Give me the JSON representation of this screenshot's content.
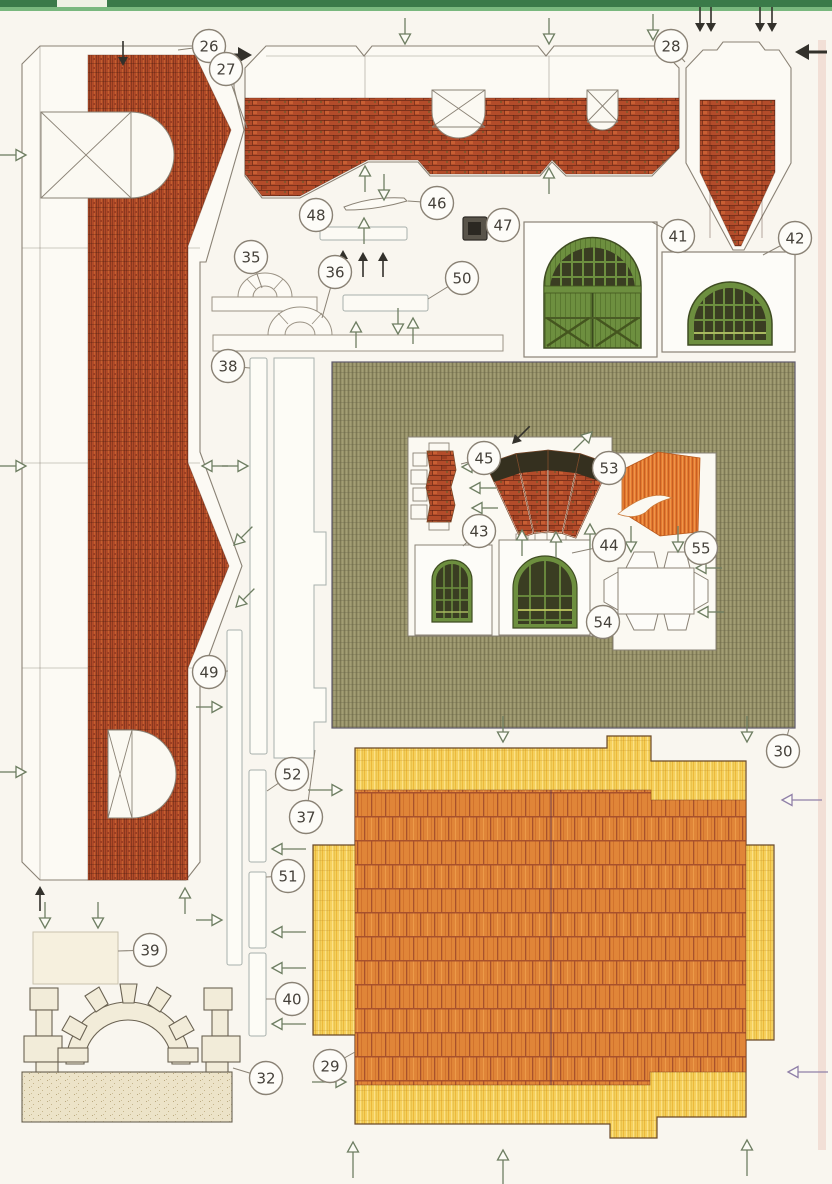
{
  "sheet": {
    "part_numbers": [
      "26",
      "27",
      "28",
      "29",
      "30",
      "32",
      "35",
      "36",
      "37",
      "38",
      "39",
      "40",
      "41",
      "42",
      "43",
      "44",
      "45",
      "46",
      "47",
      "48",
      "49",
      "50",
      "51",
      "52",
      "53",
      "54",
      "55"
    ]
  },
  "palette": {
    "page": "#f9f6ef",
    "brick": "#b04a28",
    "brick_dark": "#8f3a1f",
    "brick_light": "#c85f33",
    "olive": "#97926a",
    "olive_dark": "#7f7a55",
    "thatch": "#f5d05c",
    "thatch_dark": "#ecb93b",
    "tile_orange": "#e08538",
    "tile_line": "#a8512c",
    "door_green": "#6d8f3f",
    "pane_dark": "#3a3d22",
    "sand": "#ece3c8",
    "outline": "#8a8275",
    "arrow_open": "#6e7e62",
    "arrow_solid": "#33312b",
    "arrow_purple": "#9080a8",
    "top_bar_green": "#3a7a49",
    "top_bar_green_light": "#79b87e"
  },
  "callouts": [
    {
      "n": "26",
      "cx": 209,
      "cy": 46,
      "tx": 178,
      "ty": 50
    },
    {
      "n": "27",
      "cx": 226,
      "cy": 69,
      "tx": 247,
      "ty": 128
    },
    {
      "n": "28",
      "cx": 671,
      "cy": 46,
      "tx": 685,
      "ty": 62
    },
    {
      "n": "35",
      "cx": 251,
      "cy": 257,
      "tx": 262,
      "ty": 288
    },
    {
      "n": "36",
      "cx": 335,
      "cy": 272,
      "tx": 322,
      "ty": 318
    },
    {
      "n": "48",
      "cx": 316,
      "cy": 215,
      "tx": 324,
      "ty": 229
    },
    {
      "n": "46",
      "cx": 437,
      "cy": 203,
      "tx": 408,
      "ty": 201
    },
    {
      "n": "47",
      "cx": 503,
      "cy": 225,
      "tx": 488,
      "ty": 228
    },
    {
      "n": "50",
      "cx": 462,
      "cy": 278,
      "tx": 428,
      "ty": 299
    },
    {
      "n": "41",
      "cx": 678,
      "cy": 236,
      "tx": 652,
      "ty": 222
    },
    {
      "n": "42",
      "cx": 795,
      "cy": 238,
      "tx": 763,
      "ty": 255
    },
    {
      "n": "38",
      "cx": 228,
      "cy": 366,
      "tx": 250,
      "ty": 368
    },
    {
      "n": "30",
      "cx": 783,
      "cy": 751,
      "tx": 789,
      "ty": 729
    },
    {
      "n": "45",
      "cx": 484,
      "cy": 458,
      "tx": 461,
      "ty": 464
    },
    {
      "n": "53",
      "cx": 609,
      "cy": 468,
      "tx": 593,
      "ty": 472
    },
    {
      "n": "43",
      "cx": 479,
      "cy": 531,
      "tx": 463,
      "ty": 546
    },
    {
      "n": "44",
      "cx": 609,
      "cy": 545,
      "tx": 572,
      "ty": 553
    },
    {
      "n": "55",
      "cx": 701,
      "cy": 548,
      "tx": 695,
      "ty": 533
    },
    {
      "n": "54",
      "cx": 603,
      "cy": 622,
      "tx": 614,
      "ty": 610
    },
    {
      "n": "49",
      "cx": 209,
      "cy": 672,
      "tx": 228,
      "ty": 671
    },
    {
      "n": "52",
      "cx": 292,
      "cy": 774,
      "tx": 267,
      "ty": 791
    },
    {
      "n": "37",
      "cx": 306,
      "cy": 817,
      "tx": 315,
      "ty": 750
    },
    {
      "n": "51",
      "cx": 288,
      "cy": 876,
      "tx": 266,
      "ty": 877
    },
    {
      "n": "39",
      "cx": 150,
      "cy": 950,
      "tx": 118,
      "ty": 951
    },
    {
      "n": "40",
      "cx": 292,
      "cy": 999,
      "tx": 266,
      "ty": 999
    },
    {
      "n": "29",
      "cx": 330,
      "cy": 1066,
      "tx": 355,
      "ty": 1052
    },
    {
      "n": "32",
      "cx": 266,
      "cy": 1078,
      "tx": 233,
      "ty": 1068
    }
  ],
  "arrows": [
    {
      "x": 123,
      "y": 66,
      "d": "down",
      "s": "solid"
    },
    {
      "x": 26,
      "y": 155,
      "d": "right",
      "s": "open"
    },
    {
      "x": 252,
      "y": 55,
      "d": "right",
      "s": "solid",
      "big": true
    },
    {
      "x": 26,
      "y": 466,
      "d": "right",
      "s": "open"
    },
    {
      "x": 26,
      "y": 772,
      "d": "right",
      "s": "open"
    },
    {
      "x": 202,
      "y": 466,
      "d": "left",
      "s": "open"
    },
    {
      "x": 248,
      "y": 466,
      "d": "right",
      "s": "open"
    },
    {
      "x": 234,
      "y": 545,
      "d": "downleft",
      "s": "open"
    },
    {
      "x": 236,
      "y": 607,
      "d": "downleft",
      "s": "open"
    },
    {
      "x": 40,
      "y": 886,
      "d": "up",
      "s": "solid"
    },
    {
      "x": 185,
      "y": 888,
      "d": "up",
      "s": "open"
    },
    {
      "x": 45,
      "y": 928,
      "d": "down",
      "s": "open"
    },
    {
      "x": 98,
      "y": 928,
      "d": "down",
      "s": "open"
    },
    {
      "x": 222,
      "y": 920,
      "d": "right",
      "s": "open"
    },
    {
      "x": 222,
      "y": 707,
      "d": "right",
      "s": "open"
    },
    {
      "x": 405,
      "y": 44,
      "d": "down",
      "s": "open"
    },
    {
      "x": 549,
      "y": 44,
      "d": "down",
      "s": "open"
    },
    {
      "x": 653,
      "y": 40,
      "d": "down",
      "s": "open"
    },
    {
      "x": 365,
      "y": 166,
      "d": "up",
      "s": "open"
    },
    {
      "x": 549,
      "y": 168,
      "d": "up",
      "s": "open"
    },
    {
      "x": 384,
      "y": 200,
      "d": "down",
      "s": "open"
    },
    {
      "x": 364,
      "y": 218,
      "d": "up",
      "s": "open"
    },
    {
      "x": 343,
      "y": 250,
      "d": "up",
      "s": "solid"
    },
    {
      "x": 363,
      "y": 252,
      "d": "up",
      "s": "solid"
    },
    {
      "x": 383,
      "y": 252,
      "d": "up",
      "s": "solid"
    },
    {
      "x": 700,
      "y": 32,
      "d": "down",
      "s": "solid"
    },
    {
      "x": 711,
      "y": 32,
      "d": "down",
      "s": "solid"
    },
    {
      "x": 760,
      "y": 32,
      "d": "down",
      "s": "solid"
    },
    {
      "x": 772,
      "y": 32,
      "d": "down",
      "s": "solid"
    },
    {
      "x": 795,
      "y": 52,
      "d": "left",
      "s": "solid",
      "big": true
    },
    {
      "x": 356,
      "y": 322,
      "d": "up",
      "s": "open"
    },
    {
      "x": 398,
      "y": 334,
      "d": "down",
      "s": "open"
    },
    {
      "x": 413,
      "y": 318,
      "d": "up",
      "s": "open"
    },
    {
      "x": 462,
      "y": 467,
      "d": "left",
      "s": "open"
    },
    {
      "x": 470,
      "y": 488,
      "d": "left",
      "s": "open"
    },
    {
      "x": 472,
      "y": 508,
      "d": "left",
      "s": "open"
    },
    {
      "x": 512,
      "y": 444,
      "d": "downleft",
      "s": "solid"
    },
    {
      "x": 592,
      "y": 432,
      "d": "upright",
      "s": "open"
    },
    {
      "x": 522,
      "y": 530,
      "d": "up",
      "s": "open"
    },
    {
      "x": 556,
      "y": 532,
      "d": "up",
      "s": "open"
    },
    {
      "x": 590,
      "y": 524,
      "d": "up",
      "s": "open"
    },
    {
      "x": 631,
      "y": 552,
      "d": "down",
      "s": "open"
    },
    {
      "x": 678,
      "y": 552,
      "d": "down",
      "s": "open"
    },
    {
      "x": 696,
      "y": 568,
      "d": "left",
      "s": "open"
    },
    {
      "x": 698,
      "y": 612,
      "d": "left",
      "s": "open"
    },
    {
      "x": 503,
      "y": 742,
      "d": "down",
      "s": "open"
    },
    {
      "x": 747,
      "y": 742,
      "d": "down",
      "s": "open"
    },
    {
      "x": 272,
      "y": 849,
      "d": "left",
      "s": "open",
      "len": 24
    },
    {
      "x": 272,
      "y": 932,
      "d": "left",
      "s": "open",
      "len": 24
    },
    {
      "x": 272,
      "y": 968,
      "d": "left",
      "s": "open",
      "len": 24
    },
    {
      "x": 272,
      "y": 1024,
      "d": "left",
      "s": "open",
      "len": 24
    },
    {
      "x": 342,
      "y": 790,
      "d": "right",
      "s": "open",
      "len": 24
    },
    {
      "x": 782,
      "y": 800,
      "d": "left",
      "s": "open",
      "p": true,
      "len": 30
    },
    {
      "x": 788,
      "y": 1072,
      "d": "left",
      "s": "open",
      "p": true,
      "len": 30
    },
    {
      "x": 346,
      "y": 1082,
      "d": "right",
      "s": "open",
      "len": 24
    },
    {
      "x": 353,
      "y": 1142,
      "d": "up",
      "s": "open",
      "len": 26
    },
    {
      "x": 503,
      "y": 1150,
      "d": "up",
      "s": "open",
      "len": 26
    },
    {
      "x": 747,
      "y": 1140,
      "d": "up",
      "s": "open",
      "len": 26
    }
  ]
}
